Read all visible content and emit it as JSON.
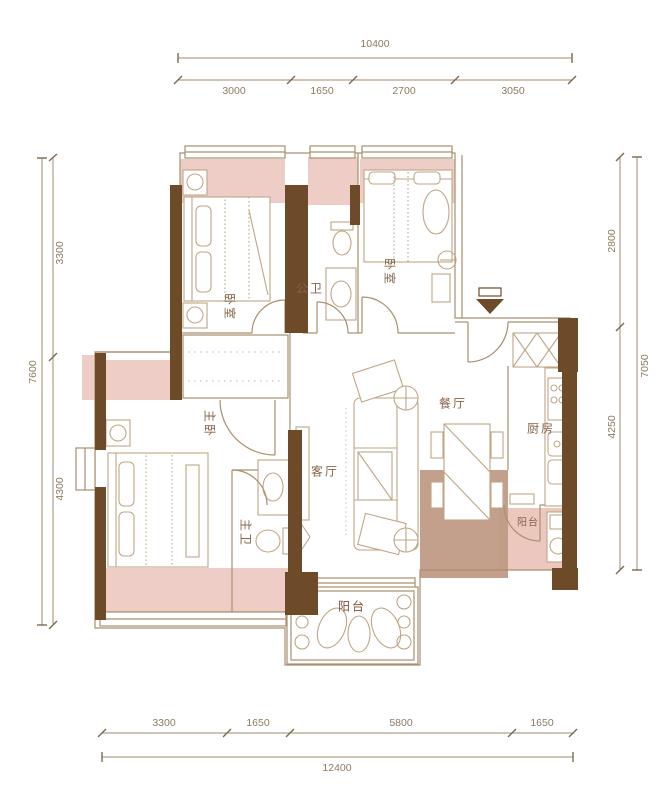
{
  "plan": {
    "type": "apartment-floor-plan",
    "rooms": {
      "bedroom_top_left": "卧室",
      "public_bath": "公卫",
      "bedroom_top_right": "卧室",
      "master_bedroom": "主卧",
      "master_bath": "主卫",
      "living_room": "客厅",
      "dining_room": "餐厅",
      "kitchen": "厨房",
      "balcony_side": "阳台",
      "balcony_bottom": "阳台"
    },
    "entrance_marker": "entrance-arrow"
  },
  "dimensions": {
    "top": {
      "total": "10400",
      "segments": [
        "3000",
        "1650",
        "2700",
        "3050"
      ]
    },
    "bottom": {
      "total": "12400",
      "segments": [
        "3300",
        "1650",
        "5800",
        "1650"
      ]
    },
    "left": {
      "total": "7600",
      "segments": [
        "3300",
        "4300"
      ]
    },
    "right": {
      "total": "7050",
      "segments": [
        "2800",
        "4250"
      ]
    }
  },
  "colors": {
    "wall": "#6d4b28",
    "thin_line": "#a8906f",
    "furniture_line": "#c0a585",
    "window_shade_pink": "#edcdc5",
    "dining_floor_tan": "#bd9881",
    "balcony_floor_tan": "#b28a70",
    "dimension_line": "#a08a6d",
    "dimension_text": "#8c7a5f",
    "room_label_text": "#85644a",
    "background": "#ffffff"
  }
}
